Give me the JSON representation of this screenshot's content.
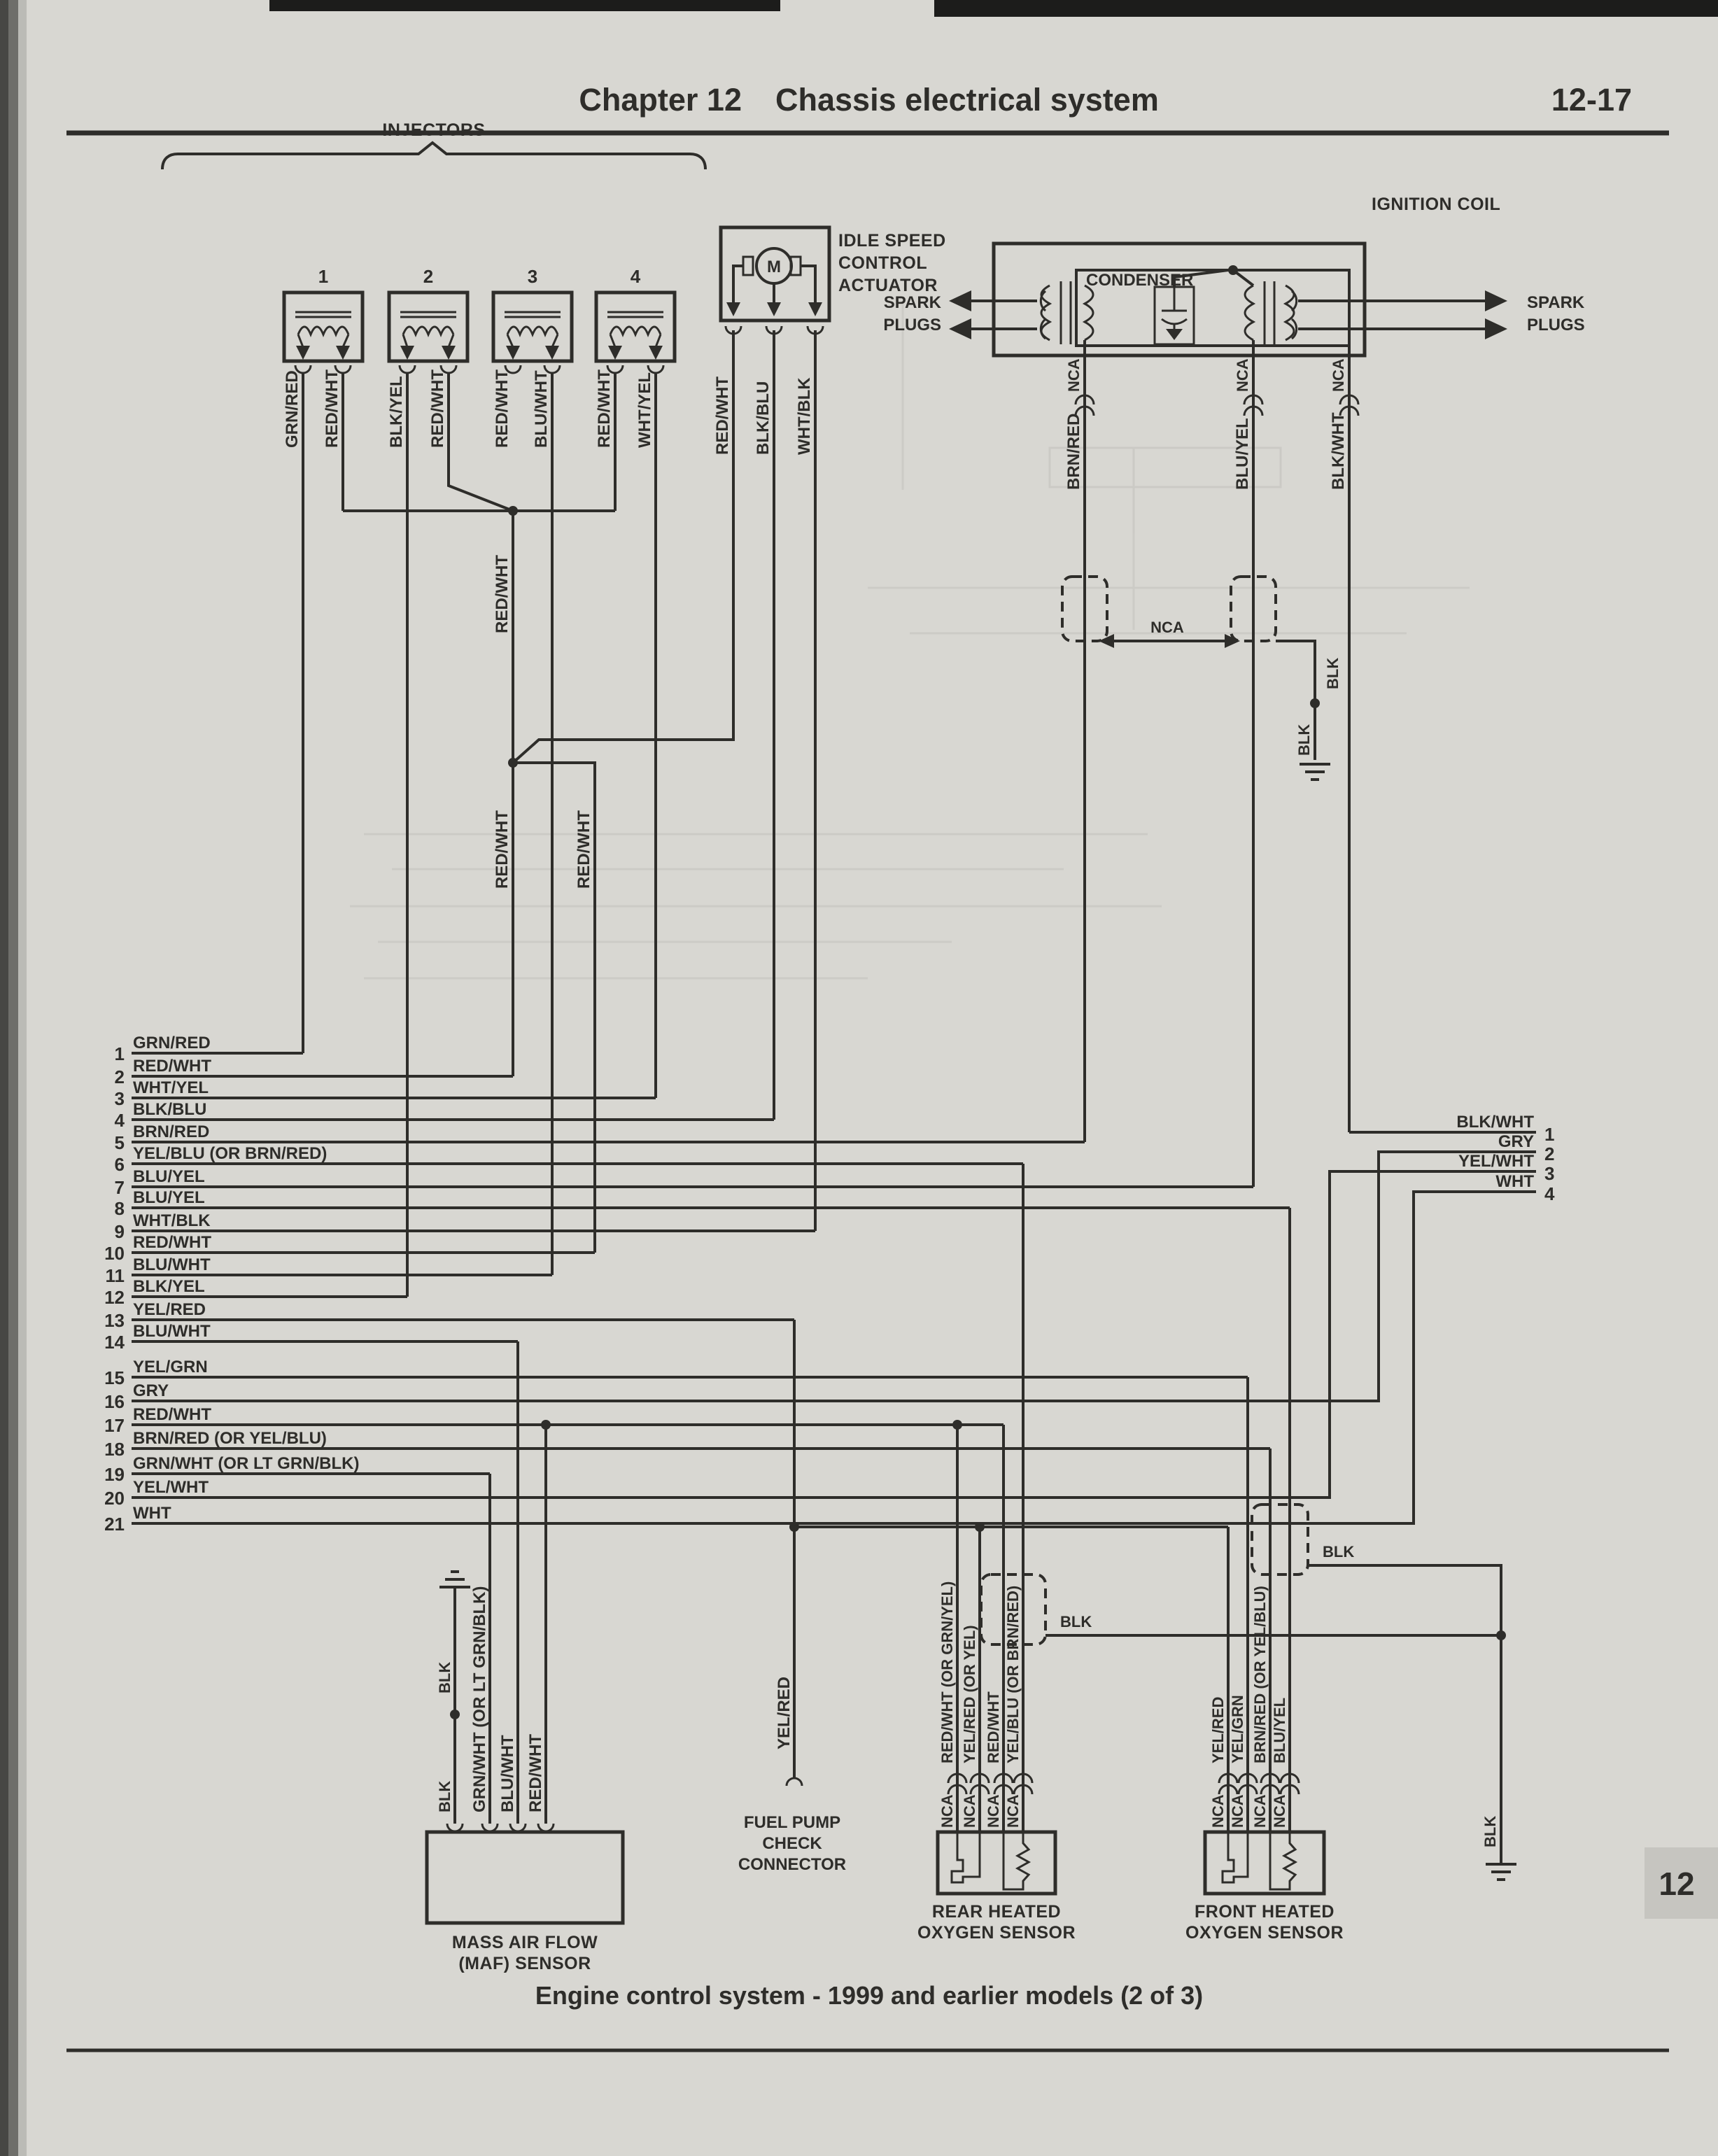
{
  "header": {
    "chapter": "Chapter 12",
    "section": "Chassis electrical system",
    "page_number": "12-17"
  },
  "footer": {
    "caption": "Engine control system - 1999 and earlier models (2 of 3)",
    "chapter_tab": "12"
  },
  "injectors": {
    "group_label": "INJECTORS",
    "units": [
      {
        "number": "1",
        "wires": [
          "GRN/RED",
          "RED/WHT"
        ]
      },
      {
        "number": "2",
        "wires": [
          "BLK/YEL",
          "RED/WHT"
        ]
      },
      {
        "number": "3",
        "wires": [
          "RED/WHT",
          "BLU/WHT"
        ]
      },
      {
        "number": "4",
        "wires": [
          "RED/WHT",
          "WHT/YEL"
        ]
      }
    ]
  },
  "idle_speed_control_actuator": {
    "label_lines": [
      "IDLE SPEED",
      "CONTROL",
      "ACTUATOR"
    ],
    "motor_letter": "M",
    "wires": [
      "RED/WHT",
      "BLK/BLU",
      "WHT/BLK"
    ]
  },
  "ignition_coil": {
    "label": "IGNITION COIL",
    "condenser_label": "CONDENSER",
    "spark_plugs_left": [
      "SPARK",
      "PLUGS"
    ],
    "spark_plugs_right": [
      "SPARK",
      "PLUGS"
    ],
    "wires": [
      {
        "nca": "NCA",
        "color": "BRN/RED"
      },
      {
        "nca": "NCA",
        "color": "BLU/YEL"
      },
      {
        "nca": "NCA",
        "color": "BLK/WHT"
      }
    ],
    "nca_link_label": "NCA",
    "ground_wire_upper": "BLK",
    "ground_wire_lower": "BLK"
  },
  "junctions": {
    "red_wht_top": "RED/WHT",
    "red_wht_left": "RED/WHT",
    "red_wht_right": "RED/WHT"
  },
  "left_pins": [
    {
      "num": "1",
      "label": "GRN/RED"
    },
    {
      "num": "2",
      "label": "RED/WHT"
    },
    {
      "num": "3",
      "label": "WHT/YEL"
    },
    {
      "num": "4",
      "label": "BLK/BLU"
    },
    {
      "num": "5",
      "label": "BRN/RED"
    },
    {
      "num": "6",
      "label": "YEL/BLU (OR BRN/RED)"
    },
    {
      "num": "7",
      "label": "BLU/YEL"
    },
    {
      "num": "8",
      "label": "BLU/YEL"
    },
    {
      "num": "9",
      "label": "WHT/BLK"
    },
    {
      "num": "10",
      "label": "RED/WHT"
    },
    {
      "num": "11",
      "label": "BLU/WHT"
    },
    {
      "num": "12",
      "label": "BLK/YEL"
    },
    {
      "num": "13",
      "label": "YEL/RED"
    },
    {
      "num": "14",
      "label": "BLU/WHT"
    },
    {
      "num": "15",
      "label": "YEL/GRN"
    },
    {
      "num": "16",
      "label": "GRY"
    },
    {
      "num": "17",
      "label": "RED/WHT"
    },
    {
      "num": "18",
      "label": "BRN/RED (OR YEL/BLU)"
    },
    {
      "num": "19",
      "label": "GRN/WHT (OR LT GRN/BLK)"
    },
    {
      "num": "20",
      "label": "YEL/WHT"
    },
    {
      "num": "21",
      "label": "WHT"
    }
  ],
  "right_pins": [
    {
      "num": "1",
      "label": "BLK/WHT"
    },
    {
      "num": "2",
      "label": "GRY"
    },
    {
      "num": "3",
      "label": "YEL/WHT"
    },
    {
      "num": "4",
      "label": "WHT"
    }
  ],
  "maf_sensor": {
    "label_lines": [
      "MASS AIR FLOW",
      "(MAF) SENSOR"
    ],
    "ground_wire_upper": "BLK",
    "wires": [
      "BLK",
      "GRN/WHT (OR LT GRN/BLK)",
      "BLU/WHT",
      "RED/WHT"
    ]
  },
  "fuel_pump": {
    "wire": "YEL/RED",
    "label_lines": [
      "FUEL PUMP",
      "CHECK",
      "CONNECTOR"
    ]
  },
  "rear_o2": {
    "label_lines": [
      "REAR HEATED",
      "OXYGEN SENSOR"
    ],
    "ground_wire": "BLK",
    "wires": [
      {
        "color": "RED/WHT (OR GRN/YEL)",
        "nca": "NCA"
      },
      {
        "color": "YEL/RED (OR YEL)",
        "nca": "NCA"
      },
      {
        "color": "RED/WHT",
        "nca": "NCA"
      },
      {
        "color": "YEL/BLU (OR BRN/RED)",
        "nca": "NCA"
      }
    ]
  },
  "front_o2": {
    "label_lines": [
      "FRONT HEATED",
      "OXYGEN SENSOR"
    ],
    "ground_wire": "BLK",
    "wires": [
      {
        "color": "YEL/RED",
        "nca": "NCA"
      },
      {
        "color": "YEL/GRN",
        "nca": "NCA"
      },
      {
        "color": "BRN/RED (OR YEL/BLU)",
        "nca": "NCA"
      },
      {
        "color": "BLU/YEL",
        "nca": "NCA"
      }
    ]
  },
  "right_ground": {
    "wire": "BLK"
  },
  "colors": {
    "paper": "#d8d7d2",
    "ink": "#2e2d2a",
    "tab_bg": "#c6c5c0"
  }
}
